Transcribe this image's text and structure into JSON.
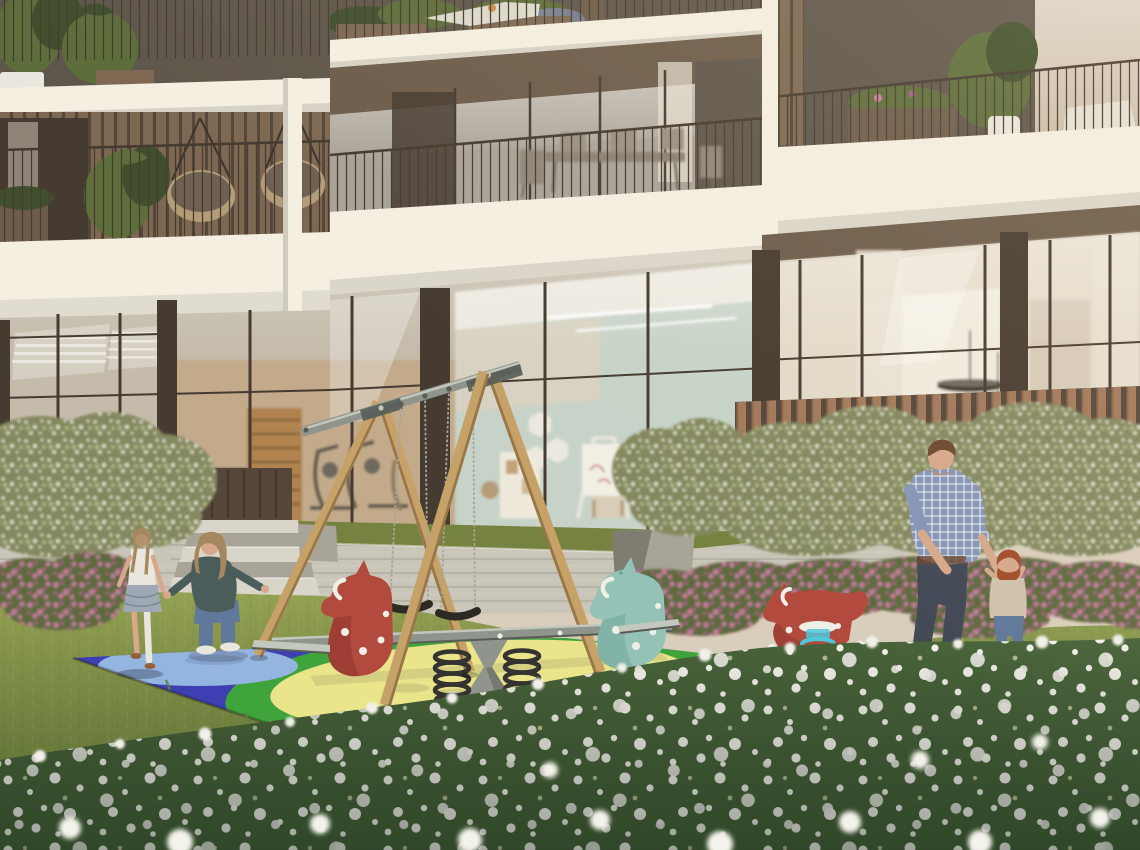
{
  "scene": {
    "title": "Courtyard playground architectural rendering",
    "description": "Photorealistic rendering of a residential courtyard: a wooden A-frame swing set, a double spring seesaw with red and teal horse heads, and a red horse spring rider stand on a blue, yellow and green rubber safety mat laid over a lawn dotted with white wildflowers. Behind them a modern cream apartment building shows balconies with planters and hanging chairs, a ground-floor gym and a children's playroom behind floor-to-ceiling glass, a concrete retaining wall with steps, wooden fence, green hedges and pink rose bushes. A woman kneels with open arms toward a walking girl on the left; a man holds a red-haired toddler's hands on the right.",
    "objects": [
      "apartment-building",
      "balconies",
      "swing-set",
      "seesaw",
      "spring-rider",
      "safety-mat",
      "lawn",
      "wildflower-meadow",
      "hedges",
      "rose-bushes",
      "retaining-wall",
      "steps",
      "wood-fence",
      "gym-interior",
      "playroom-interior",
      "girl",
      "woman",
      "man",
      "toddler"
    ]
  },
  "palette": {
    "facade": "#d9cebb",
    "slab": "#f4efe1",
    "soffit": "#6d5c4a",
    "frame": "#463b30",
    "dark_interior": "#5f564b",
    "wood_slat": "#7e6852",
    "slat_dark": "#55463a",
    "fence_wood": "#a2795a",
    "rattan": "#b59c79",
    "blind": "#cdc0ac",
    "curtain": "#e7dfd1",
    "glass_upper": "#a9a298",
    "glass_ground": "#c4bbaa",
    "interior_gym": "#c2aa8b",
    "interior_wood": "#b0834f",
    "interior_mint": "#c7d3c8",
    "interior_ceiling": "#ece9df",
    "interior_right": "#e3dac8",
    "pendant": "#39342d",
    "concrete": "#c9c5b8",
    "concrete_shadow": "#a8a498",
    "step": "#d9d5c9",
    "grass_strip": "#76823f",
    "lawn": "#94a253",
    "lawn_deep": "#637e41",
    "meadow": "#48633a",
    "hedge": "#84885f",
    "hedge_light": "#b7bd90",
    "speckle": "#edefdb",
    "pink": "#c77d9f",
    "pink_deep": "#a55e80",
    "leaf": "#5d6b3c",
    "mat_blue": "#3d3fb2",
    "mat_blue_deep": "#2b2d85",
    "mat_sky": "#95b5e1",
    "mat_yellow": "#eae48b",
    "mat_green": "#3fa43c",
    "mat_green2": "#54b53e",
    "metal": "#8f948c",
    "metal_light": "#c3c8be",
    "metal_dark": "#575c55",
    "spring_dark": "#343330",
    "wood": "#c6a168",
    "wood_dark": "#997647",
    "chain": "#a6a69e",
    "seat": "#2d2a26",
    "horse_red": "#b34a3e",
    "horse_red_deep": "#8c352d",
    "horse_teal": "#94c2b6",
    "horse_teal_deep": "#6ea396",
    "dot": "#eef0e8",
    "cyan": "#4fc6d9",
    "skin": "#d7a88b",
    "hair": "#6b4930",
    "hair_light": "#a5885f",
    "hair_red": "#a24d2b",
    "plaid": "#8595b6",
    "jeans": "#414855",
    "denim": "#60789a",
    "teal_top": "#4a5d5b",
    "white_cloth": "#e9e6dd",
    "shirt_beige": "#cfc3ae",
    "skirt": "#9fa9b5",
    "shoe": "#95603a",
    "shoe_dark": "#574841",
    "plant": "#5d6e3a",
    "plant_deep": "#40502d",
    "lavender": "#7e86a6"
  }
}
